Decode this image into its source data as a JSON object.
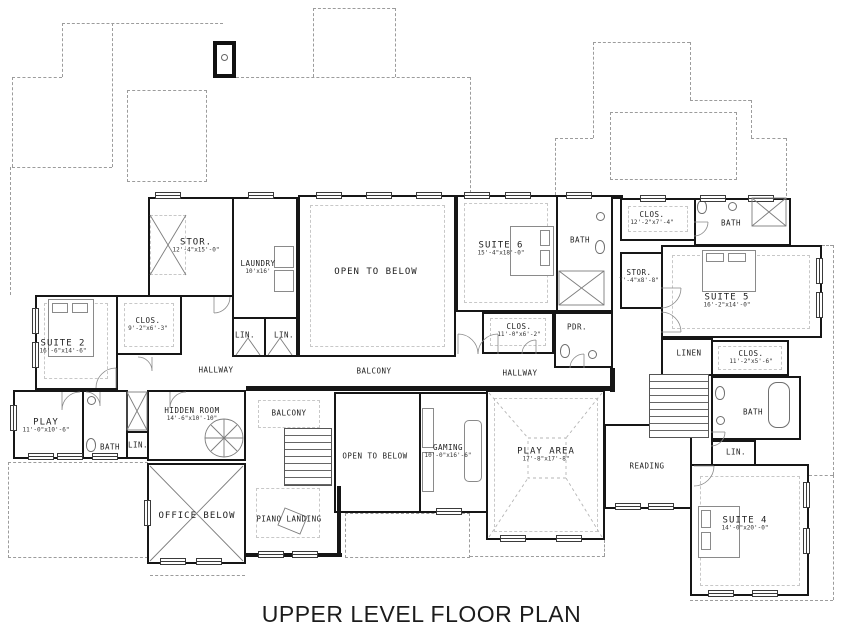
{
  "title": "UPPER LEVEL FLOOR PLAN",
  "colors": {
    "wall": "#161616",
    "roof_dash": "#9c9c9c",
    "background": "#ffffff"
  },
  "rooms": {
    "suite2": {
      "label": "SUITE 2",
      "dims": "16'-6\"x14'-6\""
    },
    "clos_suite2": {
      "label": "CLOS.",
      "dims": "9'-2\"x6'-3\""
    },
    "stor_left": {
      "label": "STOR.",
      "dims": "12'-4\"x15'-0\""
    },
    "laundry": {
      "label": "LAUNDRY",
      "dims": "10'x16'"
    },
    "lin_left1": {
      "label": "LIN."
    },
    "lin_left2": {
      "label": "LIN."
    },
    "open_below_top": {
      "label": "OPEN TO BELOW"
    },
    "hallway_left": {
      "label": "HALLWAY"
    },
    "balcony_top": {
      "label": "BALCONY"
    },
    "hallway_right": {
      "label": "HALLWAY"
    },
    "suite6": {
      "label": "SUITE 6",
      "dims": "15'-4\"x18'-0\""
    },
    "bath_suite6": {
      "label": "BATH"
    },
    "clos_suite6": {
      "label": "CLOS.",
      "dims": "11'-0\"x6'-2\""
    },
    "pdr": {
      "label": "PDR."
    },
    "clos_topright": {
      "label": "CLOS.",
      "dims": "12'-2\"x7'-4\""
    },
    "bath_topright": {
      "label": "BATH"
    },
    "stor_right": {
      "label": "STOR.",
      "dims": "7'-4\"x8'-8\""
    },
    "suite5": {
      "label": "SUITE 5",
      "dims": "16'-2\"x14'-0\""
    },
    "linen": {
      "label": "LINEN"
    },
    "clos_right": {
      "label": "CLOS.",
      "dims": "11'-2\"x5'-6\""
    },
    "bath_right": {
      "label": "BATH"
    },
    "lin_right": {
      "label": "LIN."
    },
    "reading": {
      "label": "READING"
    },
    "suite4": {
      "label": "SUITE 4",
      "dims": "14'-0\"x20'-0\""
    },
    "play": {
      "label": "PLAY",
      "dims": "11'-0\"x10'-6\""
    },
    "bath_left": {
      "label": "BATH"
    },
    "lin_bottomleft": {
      "label": "LIN."
    },
    "hidden_room": {
      "label": "HIDDEN ROOM",
      "dims": "14'-6\"x10'-10\""
    },
    "balcony_lower": {
      "label": "BALCONY"
    },
    "open_below_bottom": {
      "label": "OPEN TO BELOW"
    },
    "gaming": {
      "label": "GAMING",
      "dims": "10'-0\"x16'-6\""
    },
    "play_area": {
      "label": "PLAY AREA",
      "dims": "17'-8\"x17'-8\""
    },
    "piano_landing": {
      "label": "PIANO LANDING"
    },
    "office_below": {
      "label": "OFFICE BELOW"
    }
  }
}
